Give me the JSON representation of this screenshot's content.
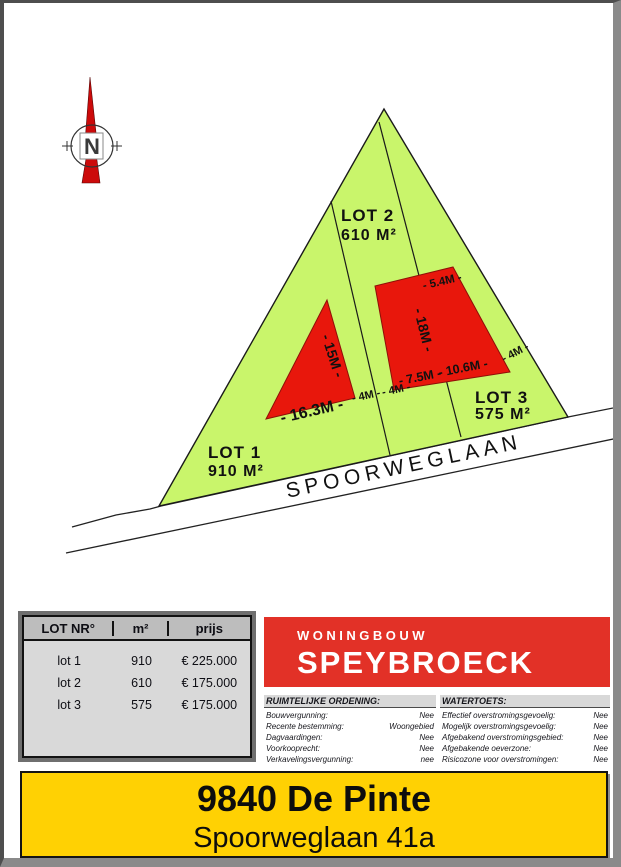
{
  "compass": {
    "label": "N"
  },
  "site_plan": {
    "street_label": "SPOORWEGLAAN",
    "lots": [
      {
        "label": "LOT 1",
        "area": "910 M²"
      },
      {
        "label": "LOT 2",
        "area": "610 M²"
      },
      {
        "label": "LOT 3",
        "area": "575 M²"
      }
    ],
    "measurements": {
      "lot1_side": "- 15M -",
      "lot1_front": "- 16.3M -",
      "setback_left": "- 4M -",
      "setback_right": "- 4M -",
      "lot23_top": "- 5.4M -",
      "lot23_side": "- 18M -",
      "lot23_front_left": "- 7.5M -",
      "lot23_front_right": "- 10.6M -",
      "lot3_side": "- 4M -"
    },
    "colors": {
      "parcel_green": "#c9f56b",
      "building_zone_red": "#e8170c"
    }
  },
  "price_table": {
    "headers": [
      "LOT NR°",
      "m²",
      "prijs"
    ],
    "rows": [
      {
        "lot": "lot 1",
        "m2": "910",
        "price": "€ 225.000"
      },
      {
        "lot": "lot 2",
        "m2": "610",
        "price": "€ 175.000"
      },
      {
        "lot": "lot 3",
        "m2": "575",
        "price": "€ 175.000"
      }
    ]
  },
  "logo": {
    "line1": "WONINGBOUW",
    "line2": "SPEYBROECK",
    "brand_color": "#e23127"
  },
  "legal": {
    "left": {
      "title": "RUIMTELIJKE ORDENING:",
      "rows": [
        [
          "Bouwvergunning:",
          "Nee"
        ],
        [
          "Recente bestemming:",
          "Woongebied"
        ],
        [
          "Dagvaardingen:",
          "Nee"
        ],
        [
          "Voorkooprecht:",
          "Nee"
        ],
        [
          "Verkavelingsvergunning:",
          "nee"
        ]
      ]
    },
    "right": {
      "title": "WATERTOETS:",
      "rows": [
        [
          "Effectief overstromingsgevoelig:",
          "Nee"
        ],
        [
          "Mogelijk overstromingsgevoelig:",
          "Nee"
        ],
        [
          "Afgebakend overstromingsgebied:",
          "Nee"
        ],
        [
          "Afgebakende oeverzone:",
          "Nee"
        ],
        [
          "Risicozone voor overstromingen:",
          "Nee"
        ]
      ]
    }
  },
  "address_banner": {
    "line1": "9840 De Pinte",
    "line2": "Spoorweglaan 41a",
    "bg_color": "#ffd103"
  }
}
